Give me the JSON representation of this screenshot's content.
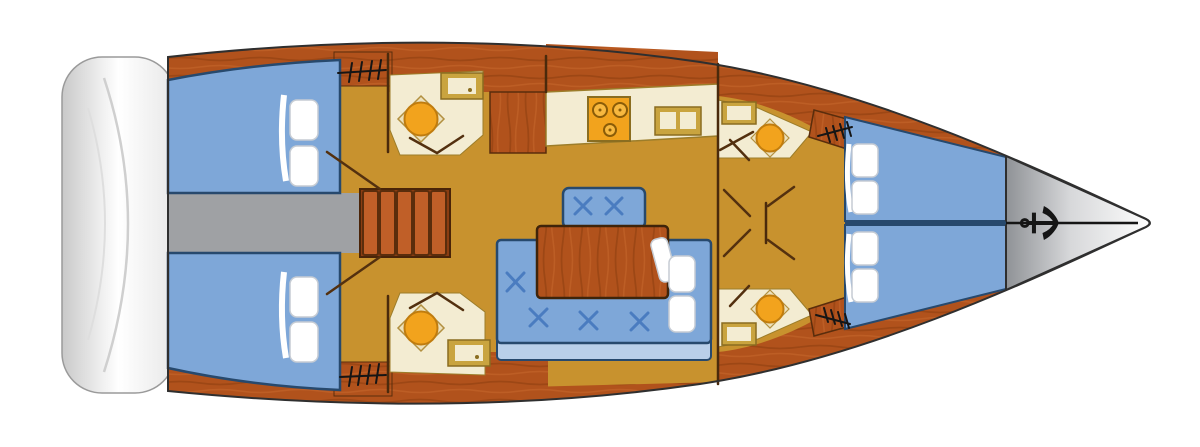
{
  "diagram": {
    "type": "sailboat-interior-deck-plan",
    "orientation": "bow-right",
    "features": [
      "stern-swim-platform",
      "aft-cabin-port-double-berth",
      "aft-cabin-starboard-double-berth",
      "companionway-corridor",
      "companionway-steps",
      "aft-head-port",
      "aft-head-starboard",
      "galley-counter",
      "stove",
      "galley-double-sink",
      "galley-cabinet",
      "salon-u-settee",
      "salon-bench",
      "salon-table",
      "seat-cushions-with-stitching",
      "forward-head-port",
      "forward-head-starboard",
      "toilets",
      "washbasins",
      "forward-vberth-port",
      "forward-vberth-starboard",
      "pillows",
      "deck-hatch-symbols",
      "door-swing-marks",
      "bow-deck",
      "anchor-windlass"
    ]
  },
  "colors": {
    "background": "#ffffff",
    "hull-wood": "#b1521c",
    "wood-dark": "#8c3d0e",
    "wood-light": "#ca6a2d",
    "floor-tan": "#c8922e",
    "cream": "#f3ecd2",
    "frame-tan": "#c9a43f",
    "frame-edge": "#8a6d20",
    "toilet-orange": "#f2a31d",
    "toilet-edge": "#c07c0e",
    "seat-khaki": "#ece1bd",
    "seat-khaki-edge": "#b29040",
    "bed-blue": "#7ea7d8",
    "navy": "#27496d",
    "stitch-blue": "#4a7cc0",
    "strip-blue": "#b9cfe9",
    "corridor-gray": "#9fa1a4",
    "step-wood": "#c05f28",
    "step-edge": "#5a2d0c",
    "step-base": "#8a3d12",
    "bow-gray-dark": "#8f9296",
    "bow-gray-mid": "#d7d8da",
    "bow-gray-light": "#fdfdfd",
    "outline-dark": "#2f2f2f",
    "door-brown": "#53300f",
    "wall-brown": "#4a2a0c",
    "hatch-black": "#151515",
    "pillow-white": "#ffffff",
    "pillow-shade": "#c6ccd4",
    "transom-edge": "#c9c9c9",
    "transom-soft": "#e8e8e8",
    "counter-edge": "#9c7d2a",
    "burner-fill": "#f7b83f",
    "burner-ring": "#8a5c08"
  }
}
